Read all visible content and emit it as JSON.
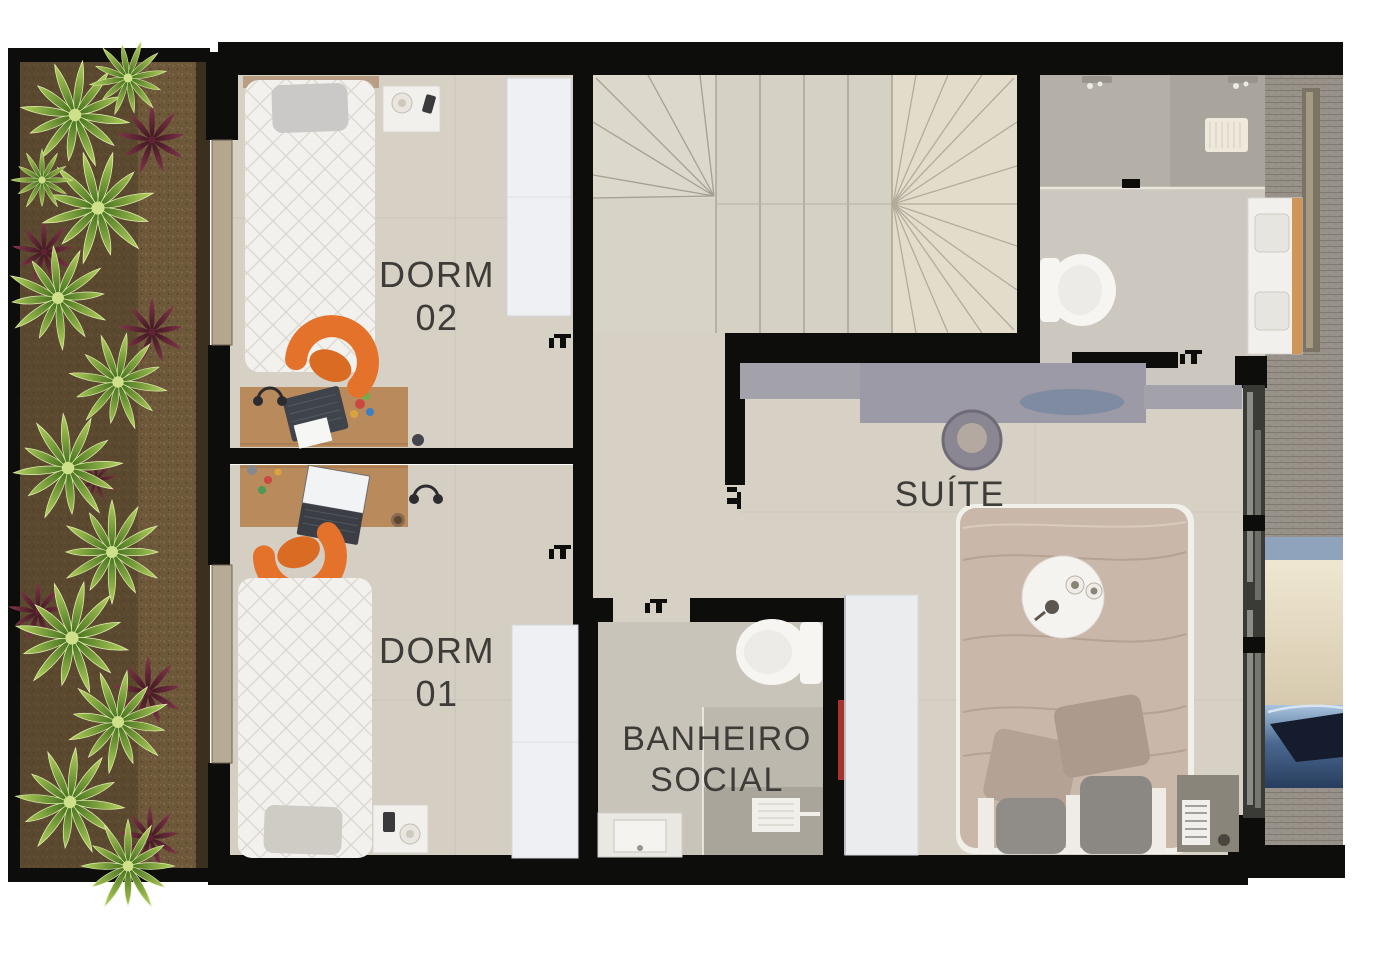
{
  "document": {
    "kind": "apartment upper-floor plan rendering",
    "background": "#ffffff"
  },
  "rooms": [
    {
      "id": "dorm-02",
      "label": [
        "DORM",
        "02"
      ]
    },
    {
      "id": "dorm-01",
      "label": [
        "DORM",
        "01"
      ]
    },
    {
      "id": "banheiro-social",
      "label": [
        "BANHEIRO",
        "SOCIAL"
      ]
    },
    {
      "id": "suite",
      "label": [
        "SUÍTE"
      ]
    }
  ],
  "colors": {
    "wall": "#0d0d0c",
    "floor_light": "#d6d0c5",
    "floor_bath": "#c9c4ba",
    "shower_tile": "#b2aea4",
    "stair_fan_light": "#e3dccb",
    "label_text": "#3e3c38",
    "desk_wood": "#b98a5c",
    "chair_orange": "#e4722a",
    "bed_white": "#f3f1ee",
    "suite_duvet": "#c9b7a9",
    "suite_desk_gray": "#9b9aa6",
    "garden_soil": "#6d583a",
    "plant_green": "#6f9c2e",
    "plant_red": "#632635",
    "exterior_brick": "#98928a",
    "awning_cream": "#e7ddc6",
    "car_blue": "#5d82b2",
    "window_tan": "#b5a68e"
  },
  "furniture_icons": [
    "single-bed-icon",
    "double-bed-icon",
    "pillow-icon",
    "desk-icon",
    "office-chair-icon",
    "laptop-icon",
    "wardrobe-icon",
    "nightstand-icon",
    "lamp-icon",
    "toilet-icon",
    "shower-icon",
    "sink-vanity-icon",
    "stairs-icon",
    "plant-icon",
    "serving-tray-icon",
    "bench-icon",
    "sliding-door-icon",
    "window-icon",
    "door-swing-icon",
    "car-icon"
  ]
}
